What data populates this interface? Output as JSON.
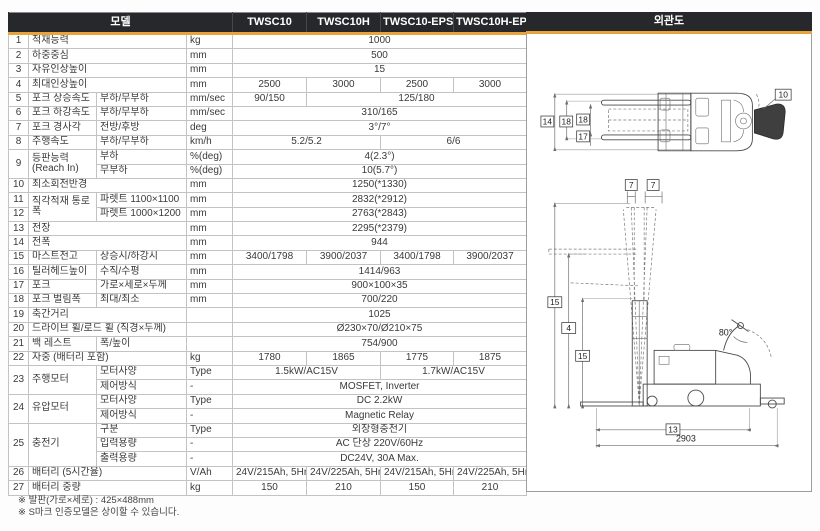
{
  "header": {
    "model_label": "모델",
    "models": [
      "TWSC10",
      "TWSC10H",
      "TWSC10-EPS",
      "TWSC10H-EPS"
    ],
    "diagram_label": "외관도"
  },
  "colors": {
    "header_bg": "#27282b",
    "accent_gold": "#e8a33d",
    "value_cell_bg": "#f1f1ef",
    "border_light": "#c3c3c1",
    "border_dark": "#8a8a8a"
  },
  "table": {
    "rows": [
      {
        "g": true,
        "c": [
          {
            "t": "1",
            "k": "num"
          },
          {
            "t": "적재능력",
            "k": "name",
            "cs": 2
          },
          {
            "t": "kg",
            "k": "unit"
          },
          {
            "t": "1000",
            "k": "val",
            "cs": 4
          }
        ]
      },
      {
        "g": true,
        "c": [
          {
            "t": "2",
            "k": "num"
          },
          {
            "t": "하중중심",
            "k": "name",
            "cs": 2
          },
          {
            "t": "mm",
            "k": "unit"
          },
          {
            "t": "500",
            "k": "val",
            "cs": 4
          }
        ]
      },
      {
        "g": true,
        "c": [
          {
            "t": "3",
            "k": "num"
          },
          {
            "t": "자유인상높이",
            "k": "name",
            "cs": 2
          },
          {
            "t": "mm",
            "k": "unit"
          },
          {
            "t": "15",
            "k": "val",
            "cs": 4
          }
        ]
      },
      {
        "g": true,
        "c": [
          {
            "t": "4",
            "k": "num"
          },
          {
            "t": "최대인상높이",
            "k": "name",
            "cs": 2
          },
          {
            "t": "mm",
            "k": "unit"
          },
          {
            "t": "2500",
            "k": "val"
          },
          {
            "t": "3000",
            "k": "val"
          },
          {
            "t": "2500",
            "k": "val"
          },
          {
            "t": "3000",
            "k": "val"
          }
        ]
      },
      {
        "g": true,
        "c": [
          {
            "t": "5",
            "k": "num"
          },
          {
            "t": "포크 상승속도",
            "k": "name"
          },
          {
            "t": "부하/무부하",
            "k": "sub"
          },
          {
            "t": "mm/sec",
            "k": "unit"
          },
          {
            "t": "90/150",
            "k": "val"
          },
          {
            "t": "125/180",
            "k": "val",
            "cs": 3
          }
        ]
      },
      {
        "g": true,
        "c": [
          {
            "t": "6",
            "k": "num"
          },
          {
            "t": "포크 하강속도",
            "k": "name"
          },
          {
            "t": "부하/무부하",
            "k": "sub"
          },
          {
            "t": "mm/sec",
            "k": "unit"
          },
          {
            "t": "310/165",
            "k": "val",
            "cs": 4
          }
        ]
      },
      {
        "g": true,
        "c": [
          {
            "t": "7",
            "k": "num"
          },
          {
            "t": "포크 경사각",
            "k": "name"
          },
          {
            "t": "전방/후방",
            "k": "sub"
          },
          {
            "t": "deg",
            "k": "unit"
          },
          {
            "t": "3°/7°",
            "k": "val",
            "cs": 4
          }
        ]
      },
      {
        "g": true,
        "c": [
          {
            "t": "8",
            "k": "num"
          },
          {
            "t": "주행속도",
            "k": "name"
          },
          {
            "t": "부하/무부하",
            "k": "sub"
          },
          {
            "t": "km/h",
            "k": "unit"
          },
          {
            "t": "5.2/5.2",
            "k": "val",
            "cs": 2
          },
          {
            "t": "6/6",
            "k": "val",
            "cs": 2
          }
        ]
      },
      {
        "g": true,
        "c": [
          {
            "t": "9",
            "k": "num",
            "rs": 2
          },
          {
            "t": "등판능력 (Reach In)",
            "k": "name",
            "rs": 2
          },
          {
            "t": "부하",
            "k": "sub"
          },
          {
            "t": "%(deg)",
            "k": "unit"
          },
          {
            "t": "4(2.3°)",
            "k": "val",
            "cs": 4
          }
        ]
      },
      {
        "g": false,
        "c": [
          {
            "t": "무부하",
            "k": "sub"
          },
          {
            "t": "%(deg)",
            "k": "unit"
          },
          {
            "t": "10(5.7°)",
            "k": "val",
            "cs": 4
          }
        ]
      },
      {
        "g": true,
        "c": [
          {
            "t": "10",
            "k": "num"
          },
          {
            "t": "최소회전반경",
            "k": "name",
            "cs": 2
          },
          {
            "t": "mm",
            "k": "unit"
          },
          {
            "t": "1250(*1330)",
            "k": "val",
            "cs": 4
          }
        ]
      },
      {
        "g": true,
        "c": [
          {
            "t": "11",
            "k": "num"
          },
          {
            "t": "직각적재 통로폭",
            "k": "name",
            "rs": 2
          },
          {
            "t": "파렛트 1100×1100",
            "k": "sub"
          },
          {
            "t": "mm",
            "k": "unit"
          },
          {
            "t": "2832(*2912)",
            "k": "val",
            "cs": 4
          }
        ]
      },
      {
        "g": true,
        "c": [
          {
            "t": "12",
            "k": "num"
          },
          {
            "t": "파렛트 1000×1200",
            "k": "sub"
          },
          {
            "t": "mm",
            "k": "unit"
          },
          {
            "t": "2763(*2843)",
            "k": "val",
            "cs": 4
          }
        ]
      },
      {
        "g": true,
        "c": [
          {
            "t": "13",
            "k": "num"
          },
          {
            "t": "전장",
            "k": "name",
            "cs": 2
          },
          {
            "t": "mm",
            "k": "unit"
          },
          {
            "t": "2295(*2379)",
            "k": "val",
            "cs": 4
          }
        ]
      },
      {
        "g": true,
        "c": [
          {
            "t": "14",
            "k": "num"
          },
          {
            "t": "전폭",
            "k": "name",
            "cs": 2
          },
          {
            "t": "mm",
            "k": "unit"
          },
          {
            "t": "944",
            "k": "val",
            "cs": 4
          }
        ]
      },
      {
        "g": true,
        "c": [
          {
            "t": "15",
            "k": "num"
          },
          {
            "t": "마스트전고",
            "k": "name"
          },
          {
            "t": "상승시/하강시",
            "k": "sub"
          },
          {
            "t": "mm",
            "k": "unit"
          },
          {
            "t": "3400/1798",
            "k": "val"
          },
          {
            "t": "3900/2037",
            "k": "val"
          },
          {
            "t": "3400/1798",
            "k": "val"
          },
          {
            "t": "3900/2037",
            "k": "val"
          }
        ]
      },
      {
        "g": true,
        "c": [
          {
            "t": "16",
            "k": "num"
          },
          {
            "t": "틸러헤드높이",
            "k": "name"
          },
          {
            "t": "수직/수평",
            "k": "sub"
          },
          {
            "t": "mm",
            "k": "unit"
          },
          {
            "t": "1414/963",
            "k": "val",
            "cs": 4
          }
        ]
      },
      {
        "g": true,
        "c": [
          {
            "t": "17",
            "k": "num"
          },
          {
            "t": "포크",
            "k": "name"
          },
          {
            "t": "가로×세로×두께",
            "k": "sub"
          },
          {
            "t": "mm",
            "k": "unit"
          },
          {
            "t": "900×100×35",
            "k": "val",
            "cs": 4
          }
        ]
      },
      {
        "g": true,
        "c": [
          {
            "t": "18",
            "k": "num"
          },
          {
            "t": "포크 벌림폭",
            "k": "name"
          },
          {
            "t": "최대/최소",
            "k": "sub"
          },
          {
            "t": "mm",
            "k": "unit"
          },
          {
            "t": "700/220",
            "k": "val",
            "cs": 4
          }
        ]
      },
      {
        "g": true,
        "c": [
          {
            "t": "19",
            "k": "num"
          },
          {
            "t": "축간거리",
            "k": "name",
            "cs": 2
          },
          {
            "t": "",
            "k": "unit"
          },
          {
            "t": "1025",
            "k": "val",
            "cs": 4
          }
        ]
      },
      {
        "g": true,
        "c": [
          {
            "t": "20",
            "k": "num"
          },
          {
            "t": "드라이브 휠/로드 휠 (직경×두께)",
            "k": "name",
            "cs": 2
          },
          {
            "t": "",
            "k": "unit"
          },
          {
            "t": "Ø230×70/Ø210×75",
            "k": "val",
            "cs": 4
          }
        ]
      },
      {
        "g": true,
        "c": [
          {
            "t": "21",
            "k": "num"
          },
          {
            "t": "백 레스트",
            "k": "name"
          },
          {
            "t": "폭/높이",
            "k": "sub"
          },
          {
            "t": "",
            "k": "unit"
          },
          {
            "t": "754/900",
            "k": "val",
            "cs": 4
          }
        ]
      },
      {
        "g": true,
        "c": [
          {
            "t": "22",
            "k": "num"
          },
          {
            "t": "자중 (배터리 포함)",
            "k": "name",
            "cs": 2
          },
          {
            "t": "kg",
            "k": "unit"
          },
          {
            "t": "1780",
            "k": "val"
          },
          {
            "t": "1865",
            "k": "val"
          },
          {
            "t": "1775",
            "k": "val"
          },
          {
            "t": "1875",
            "k": "val"
          }
        ]
      },
      {
        "g": true,
        "c": [
          {
            "t": "23",
            "k": "num",
            "rs": 2
          },
          {
            "t": "주행모터",
            "k": "name",
            "rs": 2
          },
          {
            "t": "모터사양",
            "k": "sub"
          },
          {
            "t": "Type",
            "k": "unit"
          },
          {
            "t": "1.5kW/AC15V",
            "k": "val",
            "cs": 2
          },
          {
            "t": "1.7kW/AC15V",
            "k": "val",
            "cs": 2
          }
        ]
      },
      {
        "g": false,
        "c": [
          {
            "t": "제어방식",
            "k": "sub"
          },
          {
            "t": "-",
            "k": "unit"
          },
          {
            "t": "MOSFET, Inverter",
            "k": "val",
            "cs": 4
          }
        ]
      },
      {
        "g": true,
        "c": [
          {
            "t": "24",
            "k": "num",
            "rs": 2
          },
          {
            "t": "유압모터",
            "k": "name",
            "rs": 2
          },
          {
            "t": "모터사양",
            "k": "sub"
          },
          {
            "t": "Type",
            "k": "unit"
          },
          {
            "t": "DC 2.2kW",
            "k": "val",
            "cs": 4
          }
        ]
      },
      {
        "g": false,
        "c": [
          {
            "t": "제어방식",
            "k": "sub"
          },
          {
            "t": "-",
            "k": "unit"
          },
          {
            "t": "Magnetic Relay",
            "k": "val",
            "cs": 4
          }
        ]
      },
      {
        "g": true,
        "c": [
          {
            "t": "25",
            "k": "num",
            "rs": 3
          },
          {
            "t": "충전기",
            "k": "name",
            "rs": 3
          },
          {
            "t": "구분",
            "k": "sub"
          },
          {
            "t": "Type",
            "k": "unit"
          },
          {
            "t": "외장형충전기",
            "k": "val",
            "cs": 4
          }
        ]
      },
      {
        "g": false,
        "c": [
          {
            "t": "입력용량",
            "k": "sub"
          },
          {
            "t": "-",
            "k": "unit"
          },
          {
            "t": "AC 단상 220V/60Hz",
            "k": "val",
            "cs": 4
          }
        ]
      },
      {
        "g": false,
        "c": [
          {
            "t": "출력용량",
            "k": "sub"
          },
          {
            "t": "-",
            "k": "unit"
          },
          {
            "t": "DC24V, 30A Max.",
            "k": "val",
            "cs": 4
          }
        ]
      },
      {
        "g": true,
        "c": [
          {
            "t": "26",
            "k": "num"
          },
          {
            "t": "배터리 (5시간율)",
            "k": "name",
            "cs": 2
          },
          {
            "t": "V/Ah",
            "k": "unit"
          },
          {
            "t": "24V/215Ah, 5Hr",
            "k": "val"
          },
          {
            "t": "24V/225Ah, 5Hr",
            "k": "val"
          },
          {
            "t": "24V/215Ah, 5Hr",
            "k": "val"
          },
          {
            "t": "24V/225Ah, 5Hr",
            "k": "val"
          }
        ]
      },
      {
        "g": true,
        "c": [
          {
            "t": "27",
            "k": "num"
          },
          {
            "t": "배터리 중량",
            "k": "name",
            "cs": 2
          },
          {
            "t": "kg",
            "k": "unit"
          },
          {
            "t": "150",
            "k": "val"
          },
          {
            "t": "210",
            "k": "val"
          },
          {
            "t": "150",
            "k": "val"
          },
          {
            "t": "210",
            "k": "val"
          }
        ]
      }
    ]
  },
  "diagram": {
    "title": "외관도",
    "labels": {
      "d14": "14",
      "d18_outer": "18",
      "d18_inner": "18",
      "d17": "17",
      "d10": "10",
      "d7a": "7",
      "d7b": "7",
      "d15_upper": "15",
      "d4": "4",
      "d15_lower": "15",
      "d80": "80°",
      "d13": "13",
      "d2903": "2903"
    }
  },
  "footnotes": [
    "※ 발판(가로×세로) : 425×488mm",
    "※ S마크 인증모델은 상이할 수 있습니다."
  ]
}
